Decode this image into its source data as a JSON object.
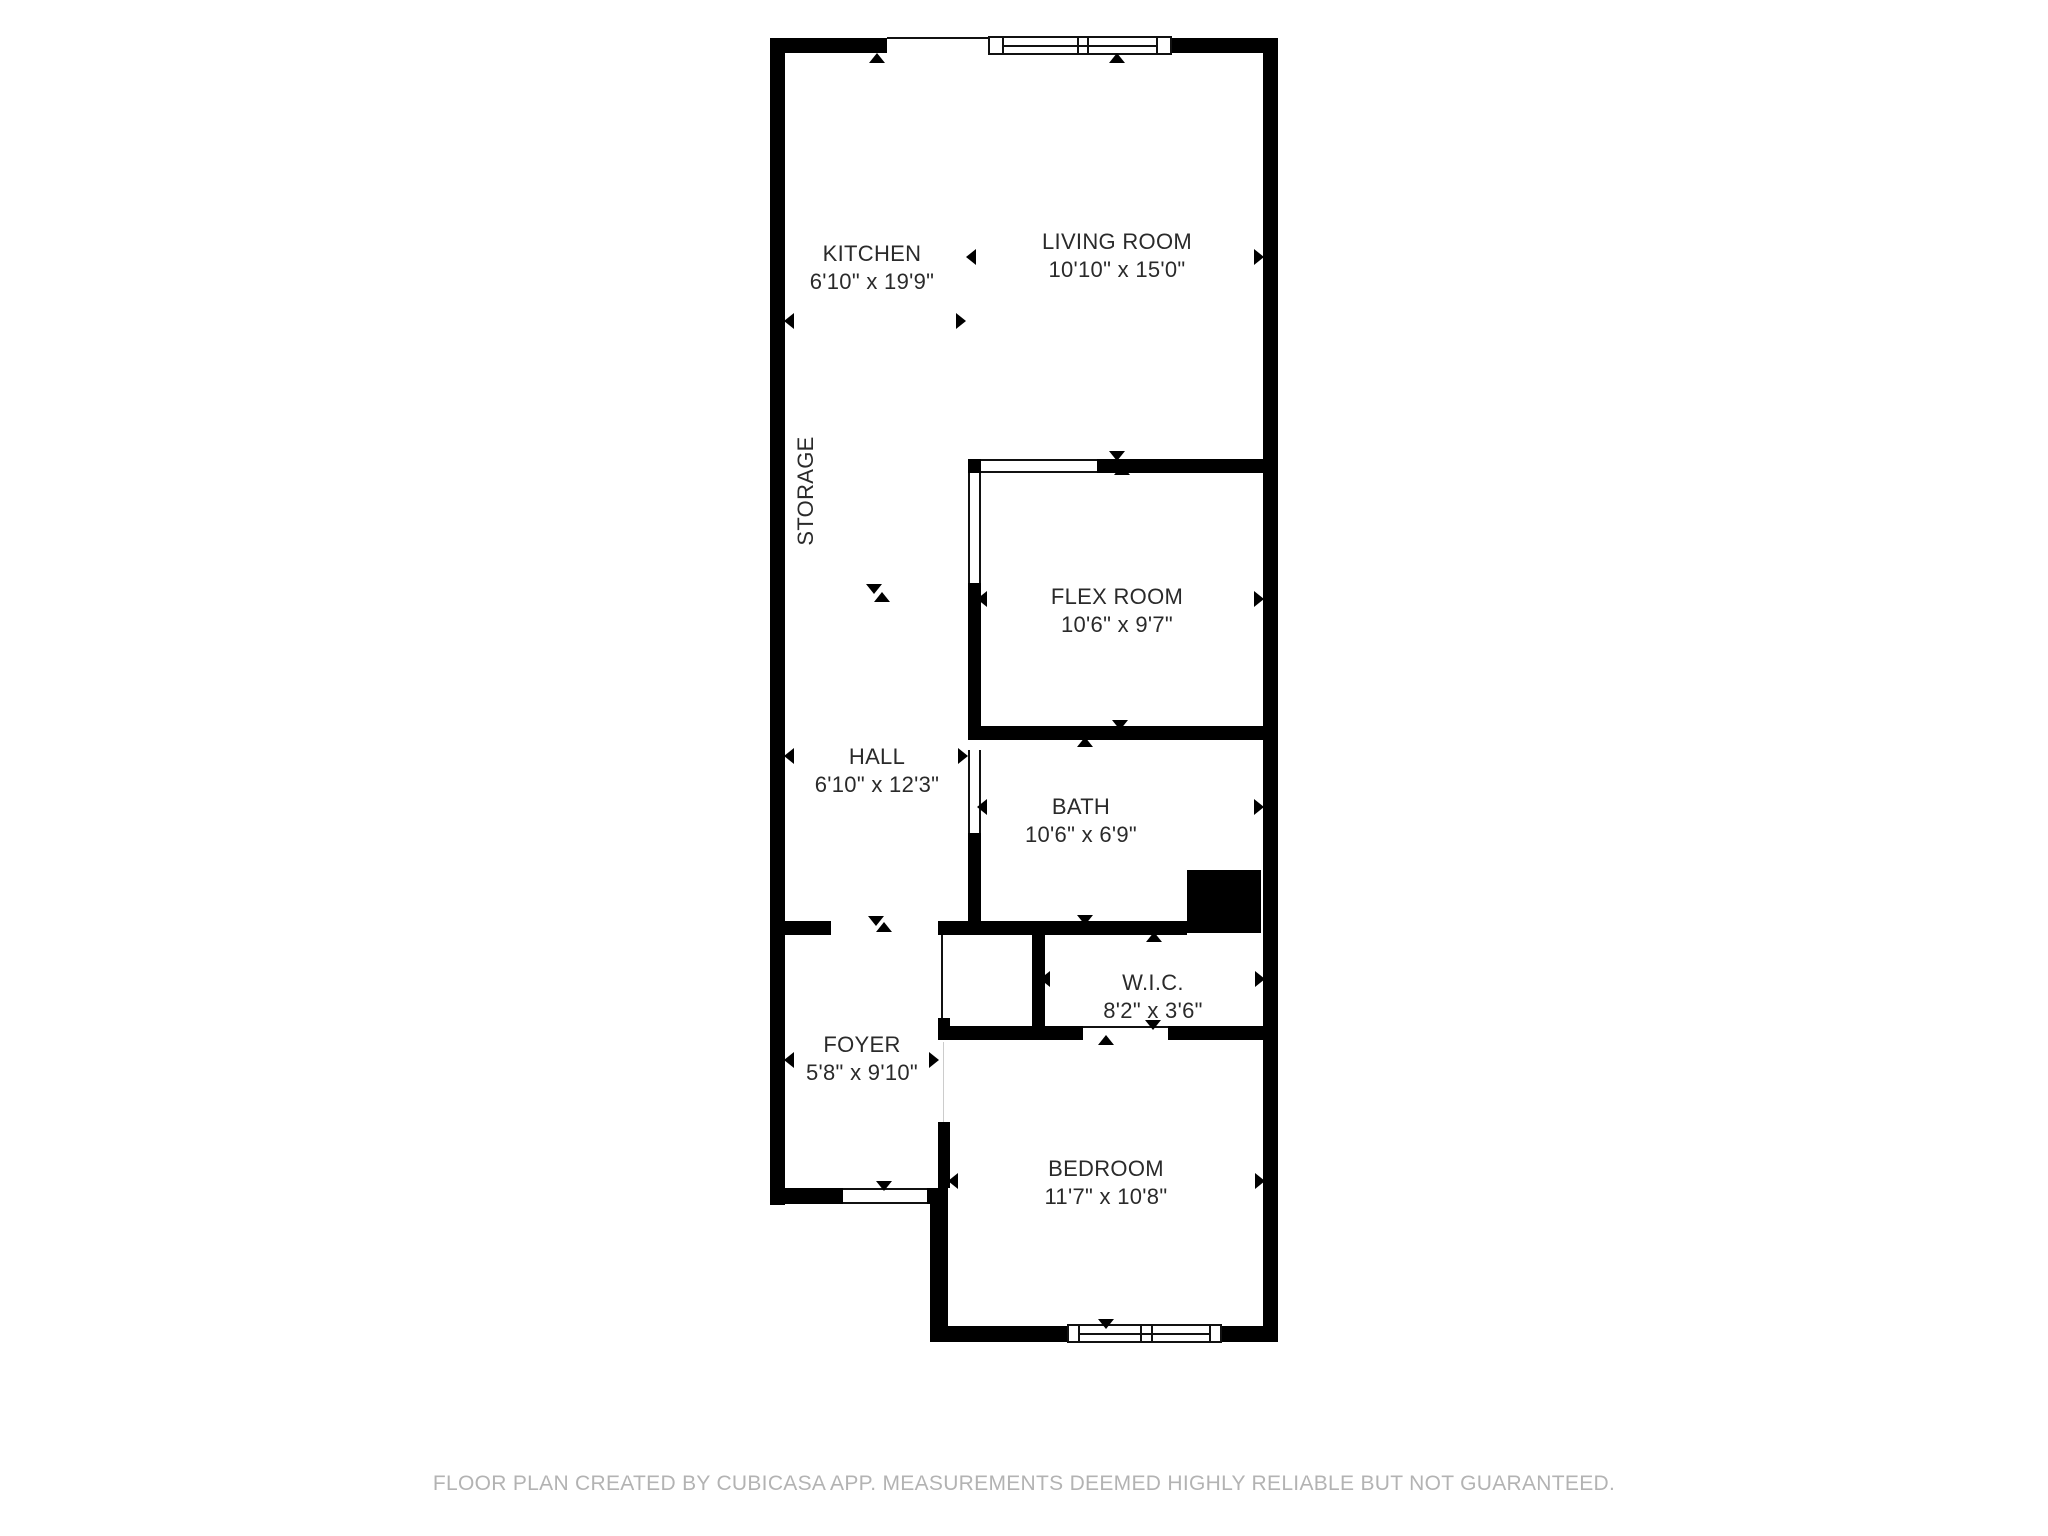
{
  "floorplan": {
    "rooms": [
      {
        "name": "KITCHEN",
        "dims": "6'10\" x 19'9\""
      },
      {
        "name": "LIVING ROOM",
        "dims": "10'10\" x 15'0\""
      },
      {
        "name": "FLEX ROOM",
        "dims": "10'6\" x 9'7\""
      },
      {
        "name": "HALL",
        "dims": "6'10\" x 12'3\""
      },
      {
        "name": "BATH",
        "dims": "10'6\" x 6'9\""
      },
      {
        "name": "W.I.C.",
        "dims": "8'2\" x 3'6\""
      },
      {
        "name": "FOYER",
        "dims": "5'8\" x 9'10\""
      },
      {
        "name": "BEDROOM",
        "dims": "11'7\" x 10'8\""
      },
      {
        "name": "STORAGE",
        "dims": ""
      }
    ],
    "footer": "FLOOR PLAN CREATED BY CUBICASA APP. MEASUREMENTS DEEMED HIGHLY RELIABLE BUT NOT GUARANTEED.",
    "colors": {
      "wall": "#000000",
      "background": "#ffffff",
      "label_text": "#2a2a2a",
      "footer_text": "#b3b3b3",
      "opening_line": "#111111"
    },
    "icons": {
      "measurement_arrow": "filled-triangle",
      "window_symbol": "framed-rectangle",
      "door_opening_symbol": "thin-line-gap"
    }
  }
}
